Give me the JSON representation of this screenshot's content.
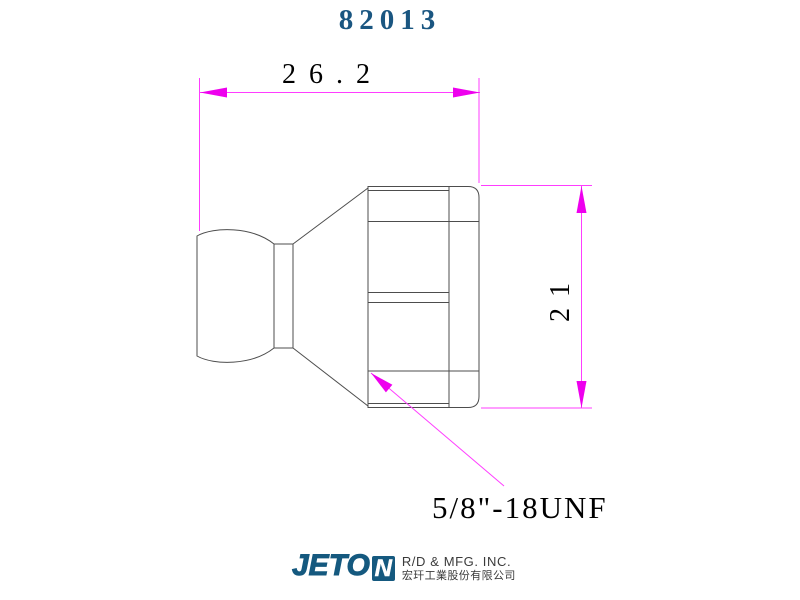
{
  "title": "82013",
  "drawing": {
    "type": "technical-drawing",
    "part": "ball-end coolant nozzle fitting, side view",
    "dim_overall_length": "26.2",
    "dim_body_height": "21",
    "thread_label": "5/8\"-18UNF"
  },
  "footer": {
    "brand_prefix": "JETO",
    "brand_last_letter": "N",
    "company_en": "R/D & MFG. INC.",
    "company_zh": "宏玕工業股份有限公司"
  },
  "colors": {
    "outline_gray": "#4d4d4d",
    "dimension_magenta_line": "#ff3dff",
    "dimension_magenta_arrow": "#ee00ee",
    "title_blue": "#1a5681",
    "logo_blue": "#15597f",
    "dimension_text": "#000000"
  }
}
